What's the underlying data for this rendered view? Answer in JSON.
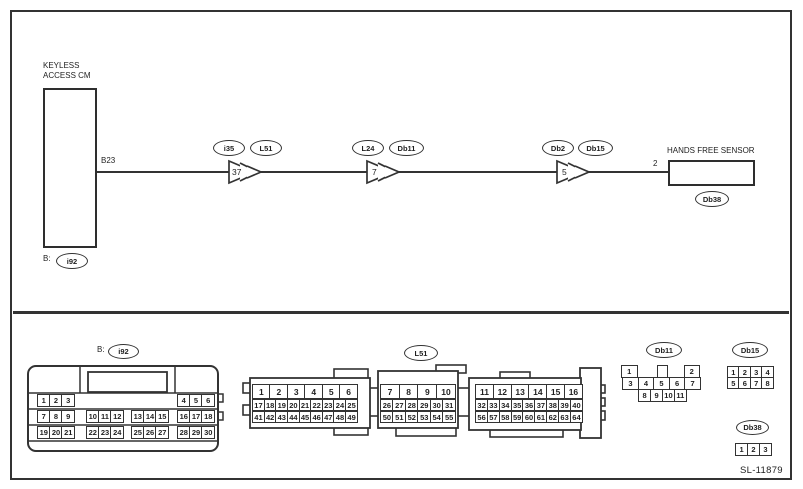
{
  "footer": {
    "code": "SL-11879"
  },
  "wiring": {
    "module": {
      "label_line1": "KEYLESS",
      "label_line2": "ACCESS CM",
      "pin": "B23",
      "connector_prefix": "B:",
      "connector": "i92"
    },
    "sensor": {
      "label": "HANDS FREE SENSOR",
      "pin": "2",
      "connector": "Db38"
    },
    "junctions": [
      {
        "number": "37",
        "from": "i35",
        "to": "L51"
      },
      {
        "number": "7",
        "from": "L24",
        "to": "Db11"
      },
      {
        "number": "5",
        "from": "Db2",
        "to": "Db15"
      }
    ]
  },
  "connectors": {
    "i92": {
      "prefix": "B:",
      "label": "i92",
      "row1": [
        [
          "1",
          "2",
          "3"
        ],
        [
          "4",
          "5",
          "6"
        ]
      ],
      "row2": [
        [
          "7",
          "8",
          "9"
        ],
        [
          "10",
          "11",
          "12"
        ],
        [
          "13",
          "14",
          "15"
        ],
        [
          "16",
          "17",
          "18"
        ]
      ],
      "row3": [
        [
          "19",
          "20",
          "21"
        ],
        [
          "22",
          "23",
          "24"
        ],
        [
          "25",
          "26",
          "27"
        ],
        [
          "28",
          "29",
          "30"
        ]
      ]
    },
    "l51": {
      "label": "L51",
      "block1": {
        "r1": [
          "1",
          "2",
          "3",
          "4",
          "5",
          "6"
        ],
        "r2": [
          "17",
          "18",
          "19",
          "20",
          "21",
          "22",
          "23",
          "24",
          "25"
        ],
        "r3": [
          "41",
          "42",
          "43",
          "44",
          "45",
          "46",
          "47",
          "48",
          "49"
        ]
      },
      "block2": {
        "r1": [
          "7",
          "8",
          "9",
          "10"
        ],
        "r2": [
          "26",
          "27",
          "28",
          "29",
          "30",
          "31"
        ],
        "r3": [
          "50",
          "51",
          "52",
          "53",
          "54",
          "55"
        ]
      },
      "block3": {
        "r1": [
          "11",
          "12",
          "13",
          "14",
          "15",
          "16"
        ],
        "r2": [
          "32",
          "33",
          "34",
          "35",
          "36",
          "37",
          "38",
          "39",
          "40"
        ],
        "r3": [
          "56",
          "57",
          "58",
          "59",
          "60",
          "61",
          "62",
          "63",
          "64"
        ]
      }
    },
    "db11": {
      "label": "Db11",
      "r1_left": "1",
      "r1_right": "2",
      "r2": [
        "3",
        "4",
        "5",
        "6",
        "7"
      ],
      "r3": [
        "8",
        "9",
        "10",
        "11"
      ]
    },
    "db15": {
      "label": "Db15",
      "r1": [
        "1",
        "2",
        "3",
        "4"
      ],
      "r2": [
        "5",
        "6",
        "7",
        "8"
      ]
    },
    "db38": {
      "label": "Db38",
      "r1": [
        "1",
        "2",
        "3"
      ]
    }
  }
}
